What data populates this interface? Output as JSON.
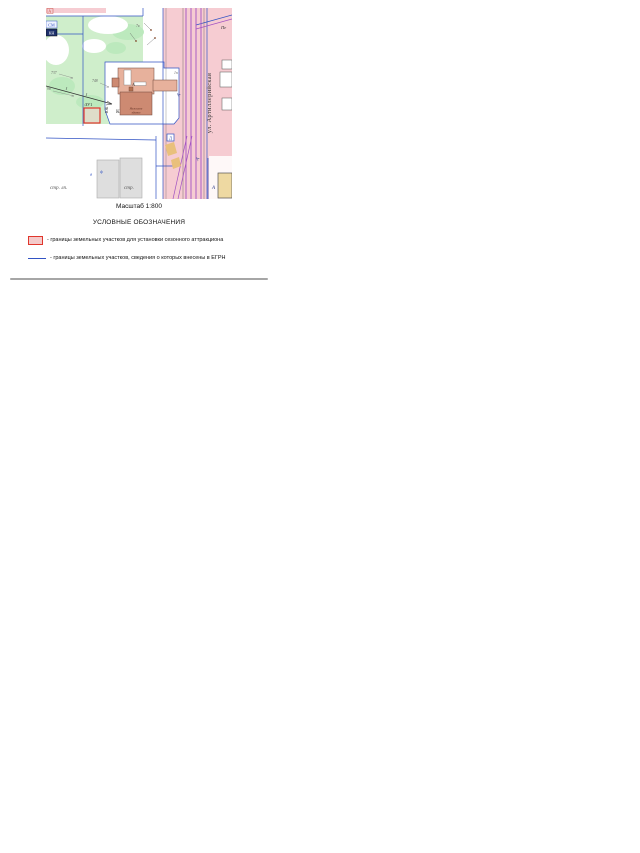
{
  "figure": {
    "scale_caption": "Масштаб 1:800",
    "legend_title": "УСЛОВНЫЕ ОБОЗНАЧЕНИЯ",
    "legend_items": [
      {
        "symbol": "red-rect",
        "text": "- границы земельных участков для установки сезонного аттракциона"
      },
      {
        "symbol": "blue-line",
        "text": "- границы земельных участков, сведения о которых внесены в ЕГРН"
      }
    ]
  },
  "map": {
    "street_name": "ул. Артиллерийская",
    "plot_label": ":ЗУ1",
    "building_name_line1": "Нежилое",
    "building_name_line2": "здание",
    "labels": {
      "corner_a": "А",
      "sm": "СМ",
      "kn": "КН",
      "n7v": "7в",
      "n737": "737",
      "n98": "98",
      "n748": "748",
      "n1p": "1п",
      "pe": "Пе",
      "yuk": "ЮК",
      "k": "К",
      "a_building": "А",
      "d_box": "Д",
      "a_road_1": "А",
      "a_road_2": "А",
      "a_road_3": "А",
      "str_lp": "стр. лп.",
      "str": "стр.",
      "g_d": "д",
      "g_f": "ф"
    },
    "colors": {
      "vegetation": "#cfeecb",
      "vegetation_dark": "#bce9bd",
      "road_pink": "#f6ccd2",
      "building_light": "#e7b19c",
      "building_dark": "#cd8a72",
      "boundary_blue": "#3253c4",
      "utility_purple": "#a252c2",
      "plot_red": "#e0362c"
    }
  }
}
